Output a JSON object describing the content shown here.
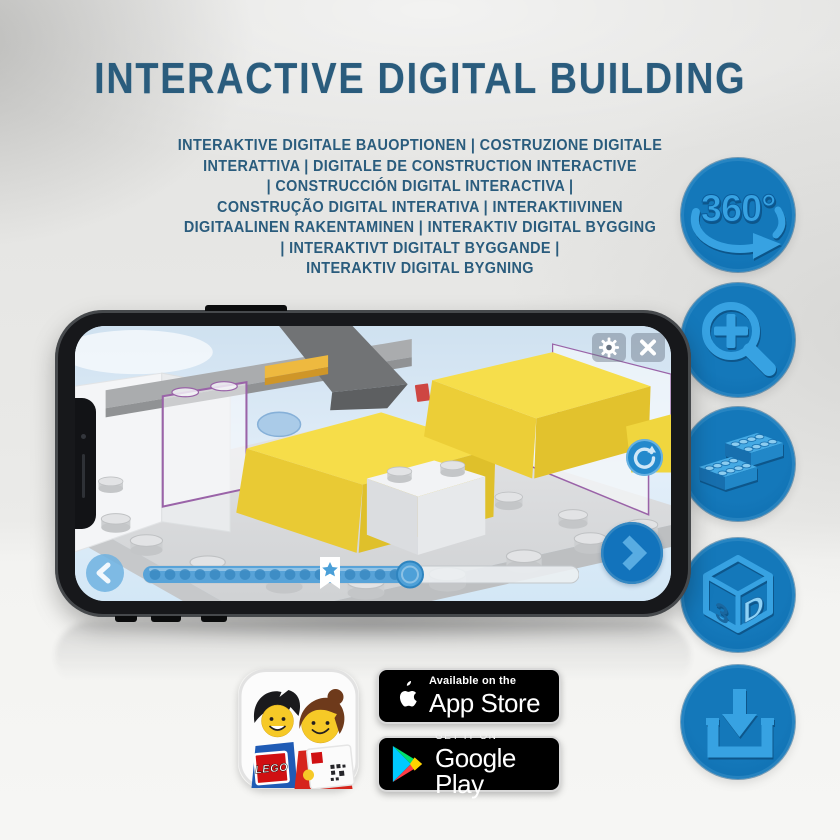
{
  "header": {
    "title": "INTERACTIVE DIGITAL BUILDING",
    "subtitle_lines": [
      "INTERAKTIVE DIGITALE BAUOPTIONEN | COSTRUZIONE DIGITALE",
      "INTERATTIVA | DIGITALE DE CONSTRUCTION INTERACTIVE",
      "| CONSTRUCCIÓN DIGITAL INTERACTIVA |",
      "CONSTRUÇÃO DIGITAL INTERATIVA | INTERAKTIIVINEN",
      "DIGITAALINEN RAKENTAMINEN | INTERAKTIV DIGITAL BYGGING",
      "| INTERAKTIVT DIGITALT BYGGANDE |",
      "INTERAKTIV DIGITAL BYGNING"
    ]
  },
  "feature_badges": [
    {
      "icon": "rotate-360-icon",
      "label": "360°"
    },
    {
      "icon": "zoom-in-icon"
    },
    {
      "icon": "lego-bricks-icon"
    },
    {
      "icon": "cube-3d-icon",
      "label_left": "3",
      "label_right": "D"
    },
    {
      "icon": "download-icon"
    }
  ],
  "store_badges": {
    "app_store": {
      "tagline": "Available on the",
      "name": "App Store"
    },
    "google_play": {
      "tagline": "GET IT ON",
      "name": "Google Play"
    }
  },
  "app_icon": {
    "brand": "LEGO"
  },
  "colors": {
    "title_text": "#2a5c7d",
    "feature_circle": "#0f70b2",
    "feature_glyph": "#37a2e2",
    "phone_screen_bg": "#dcebf7",
    "slider_fill": "#58a3d8",
    "next_button": "#1273bc",
    "brick_yellow": "#f5dc48",
    "brick_outline_purple": "#9a63a8",
    "store_badge_bg": "#000000"
  }
}
